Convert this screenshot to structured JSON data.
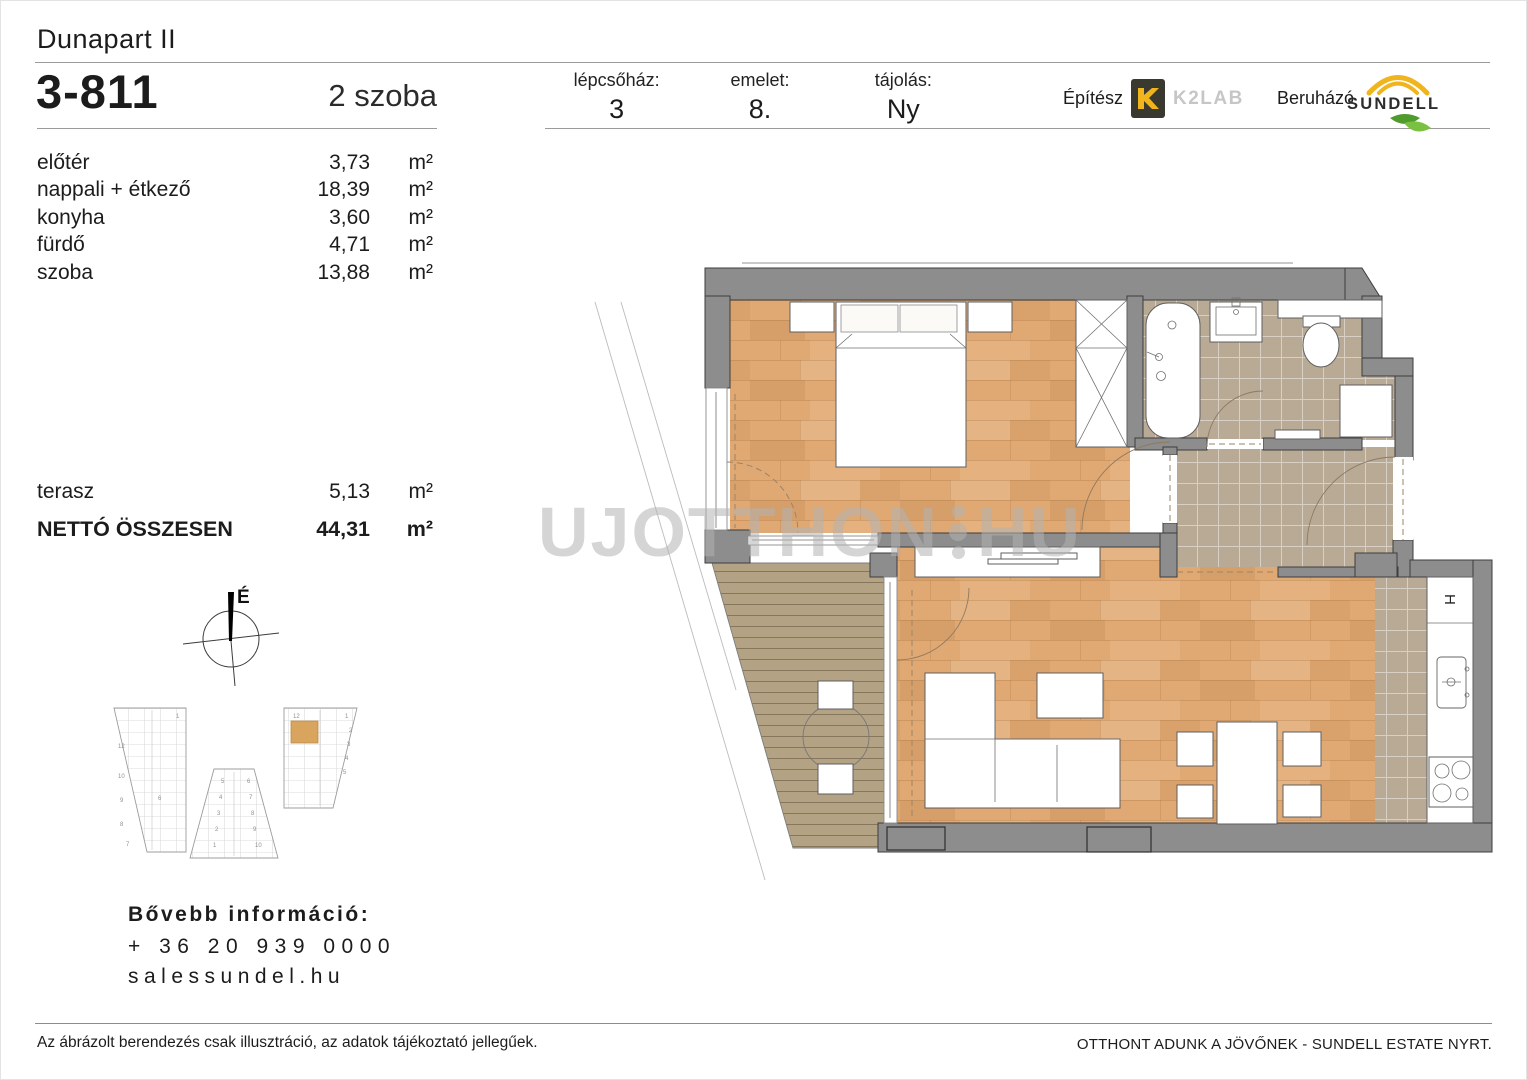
{
  "document": {
    "project_name": "Dunapart II",
    "unit_id": "3-811",
    "unit_type": "2 szoba"
  },
  "area_table": {
    "rows": [
      {
        "label": "előtér",
        "value": "3,73",
        "unit": "m²"
      },
      {
        "label": "nappali + étkező",
        "value": "18,39",
        "unit": "m²"
      },
      {
        "label": "konyha",
        "value": "3,60",
        "unit": "m²"
      },
      {
        "label": "fürdő",
        "value": "4,71",
        "unit": "m²"
      },
      {
        "label": "szoba",
        "value": "13,88",
        "unit": "m²"
      }
    ],
    "terrace": {
      "label": "terasz",
      "value": "5,13",
      "unit": "m²"
    },
    "total": {
      "label": "NETTÓ ÖSSZESEN",
      "value": "44,31",
      "unit": "m²"
    }
  },
  "details": {
    "staircase_label": "lépcsőház:",
    "staircase": "3",
    "floor_label": "emelet:",
    "floor": "8.",
    "orientation_label": "tájolás:",
    "orientation": "Ny"
  },
  "branding": {
    "architect_label": "Építész",
    "architect_name": "K2LAB",
    "developer_label": "Beruházó",
    "developer_name": "SUNDELL",
    "brand_yellow": "#f0b41c",
    "brand_green_dark": "#4f9b2d",
    "brand_green_light": "#7ac142",
    "logo_dark": "#3a392f"
  },
  "contact": {
    "heading": "Bővebb információ:",
    "phone": "+ 36 20 939 0000",
    "website": "salessundel.hu"
  },
  "footer": {
    "disclaimer": "Az ábrázolt berendezés csak illusztráció, az adatok tájékoztató jellegűek.",
    "slogan": "OTTHONT ADUNK A JÖVŐNEK - SUNDELL ESTATE NYRT."
  },
  "watermark": {
    "left": "UJOTTHON",
    "right": "HU"
  },
  "plan": {
    "compass_label": "É",
    "fridge_label": "H",
    "colors": {
      "wall": "#8d8d8d",
      "wood": "#e0a873",
      "deck": "#b3a284",
      "tile": "#b9aa96"
    }
  },
  "keyplan": {
    "highlight_color": "#d9a45e",
    "mid_digits": [
      "5",
      "6",
      "4",
      "7",
      "3",
      "8",
      "2",
      "9",
      "1",
      "10"
    ],
    "right_digits": [
      "12",
      "1",
      "2",
      "3",
      "4",
      "5"
    ],
    "left_digits": [
      "1",
      "12",
      "10",
      "9",
      "8",
      "7",
      "6"
    ]
  }
}
